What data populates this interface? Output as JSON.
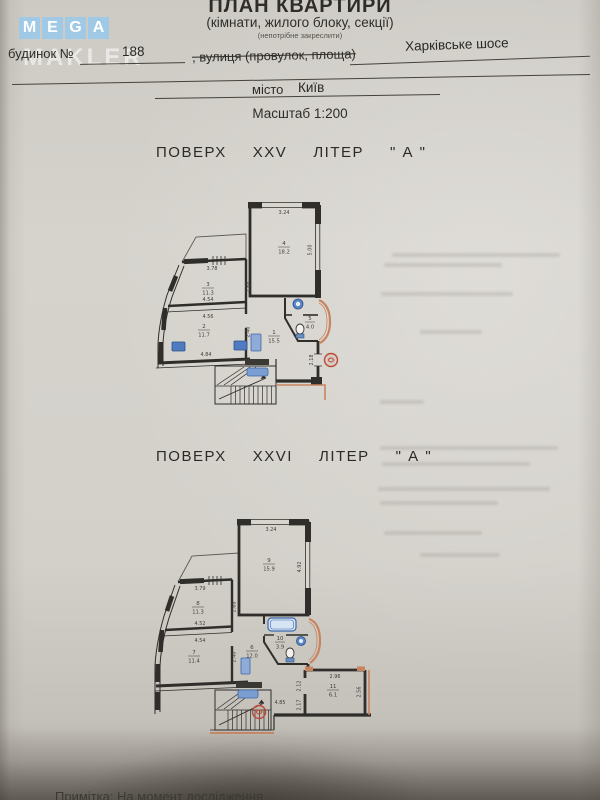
{
  "watermark": {
    "letters": [
      "M",
      "E",
      "G",
      "A"
    ],
    "word": "MAKLER"
  },
  "header": {
    "title": "ПЛАН КВАРТИРИ",
    "subtitle": "(кімнати, жилого блоку, секції)",
    "strike_note": "(непотрібне закреслити)",
    "house_label": "будинок №",
    "house_number": "188",
    "street_label": ", вулиця (провулок, площа)",
    "street_value": "Харківське шосе",
    "city_label": "місто",
    "city_value": "Київ",
    "scale": "Масштаб 1:200"
  },
  "plan25": {
    "heading": {
      "floor": "ПОВЕРХ",
      "floor_num": "XXV",
      "liter": "ЛІТЕР",
      "liter_val": "\" А \""
    },
    "rooms": {
      "r4": {
        "num": "4",
        "area": "18.2"
      },
      "r3": {
        "num": "3",
        "area": "11.3"
      },
      "r2": {
        "num": "2",
        "area": "11.7"
      },
      "r1": {
        "num": "1",
        "area": "15.5"
      },
      "r5": {
        "num": "5",
        "area": "4.0"
      }
    },
    "dims": {
      "top": "3.24",
      "right": "5.00",
      "hall_v": "2.68",
      "r3_top": "3.78",
      "div_a": "4.54",
      "div_b": "4.56",
      "hall_v2": "2.40",
      "bottom": "4.84",
      "stamp_v": "2.18"
    }
  },
  "plan26": {
    "heading": {
      "floor": "ПОВЕРХ",
      "floor_num": "XXVI",
      "liter": "ЛІТЕР",
      "liter_val": "\" А \""
    },
    "rooms": {
      "r9": {
        "num": "9",
        "area": "15.9"
      },
      "r8": {
        "num": "8",
        "area": "11.3"
      },
      "r7": {
        "num": "7",
        "area": "11.4"
      },
      "r6": {
        "num": "6",
        "area": "12.0"
      },
      "r10": {
        "num": "10",
        "area": "3.9"
      },
      "r11": {
        "num": "11",
        "area": "6.1"
      }
    },
    "dims": {
      "top": "3.24",
      "right": "4.92",
      "hall_v": "2.68",
      "r8_top": "3.79",
      "div_a": "4.52",
      "div_b": "4.54",
      "hall_v2": "2.40",
      "corridor": "4.85",
      "r11_top": "2.96",
      "r11_left": "2.12",
      "r11_right": "2.56",
      "gap": "2.17"
    }
  },
  "footer": {
    "note": "Примітка: На момент дослідження"
  }
}
